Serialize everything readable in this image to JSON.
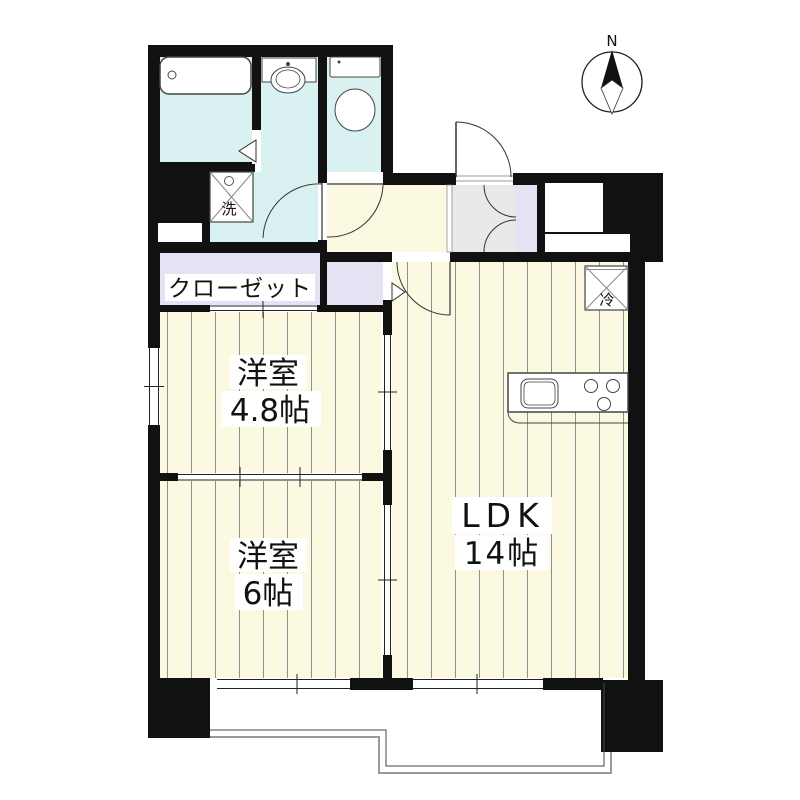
{
  "compass": {
    "label": "N"
  },
  "rooms": {
    "ldk": {
      "name": "LDK",
      "size": "14帖"
    },
    "western_4_8": {
      "name": "洋室",
      "size": "4.8帖"
    },
    "western_6": {
      "name": "洋室",
      "size": "6帖"
    },
    "closet": {
      "label": "クローゼット"
    }
  },
  "fixtures": {
    "washer_label": "洗",
    "fridge_label": "冷"
  },
  "colors": {
    "wall": "#111111",
    "room_floor": "#fcf9e1",
    "wet_area_floor": "#d9f1f1",
    "closet_floor": "#e3e3f3",
    "entrance_tile": "#e9e9e9",
    "stripe": "#8f8f8f",
    "balcony_outline": "#999999"
  }
}
